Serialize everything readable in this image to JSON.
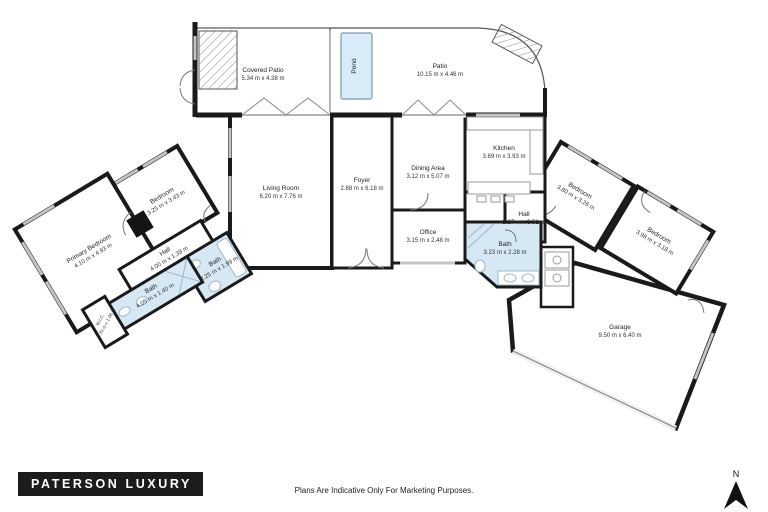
{
  "meta": {
    "brand": "PATERSON LUXURY",
    "disclaimer": "Plans Are Indicative Only For Marketing Purposes.",
    "compass_letter": "N"
  },
  "colors": {
    "wall": "#1a1a1a",
    "bath_fill": "#d5e8f4",
    "pond_fill": "#d8ecf7",
    "logo_bg": "#1c1c1c",
    "logo_text": "#ffffff"
  },
  "rooms": [
    {
      "id": "covered-patio",
      "name": "Covered Patio",
      "dims": "5.34 m x 4.38 m"
    },
    {
      "id": "patio",
      "name": "Patio",
      "dims": "10.15 m x 4.46 m"
    },
    {
      "id": "pond",
      "name": "Pond",
      "dims": ""
    },
    {
      "id": "living-room",
      "name": "Living Room",
      "dims": "6.20 m x 7.76 m"
    },
    {
      "id": "foyer",
      "name": "Foyer",
      "dims": "2.88 m x 6.18 m"
    },
    {
      "id": "dining-area",
      "name": "Dining Area",
      "dims": "3.12 m x 5.07 m"
    },
    {
      "id": "kitchen",
      "name": "Kitchen",
      "dims": "3.69 m x 3.93 m"
    },
    {
      "id": "hall-east",
      "name": "Hall",
      "dims": "2.27 m x 3.51 m"
    },
    {
      "id": "office",
      "name": "Office",
      "dims": "3.15 m x 2.48 m"
    },
    {
      "id": "bath-east",
      "name": "Bath",
      "dims": "3.23 m x 2.28 m"
    },
    {
      "id": "bedroom-east-1",
      "name": "Bedroom",
      "dims": "3.80 m x 3.26 m"
    },
    {
      "id": "bedroom-east-2",
      "name": "Bedroom",
      "dims": "3.98 m x 3.18 m"
    },
    {
      "id": "garage",
      "name": "Garage",
      "dims": "9.50 m x 6.40 m"
    },
    {
      "id": "bedroom-west",
      "name": "Bedroom",
      "dims": "3.25 m x 3.43 m"
    },
    {
      "id": "primary-bedroom",
      "name": "Primary Bedroom",
      "dims": "4.10 m x 4.93 m"
    },
    {
      "id": "hall-west",
      "name": "Hall",
      "dims": "4.00 m x 1.39 m"
    },
    {
      "id": "bath-west-small",
      "name": "Bath",
      "dims": "2.25 m x 1.99 m"
    },
    {
      "id": "bath-west-long",
      "name": "Bath",
      "dims": "4.05 m x 1.40 m"
    },
    {
      "id": "wic",
      "name": "W.I.C.",
      "dims": "0.70 m x 1.06 m"
    }
  ]
}
